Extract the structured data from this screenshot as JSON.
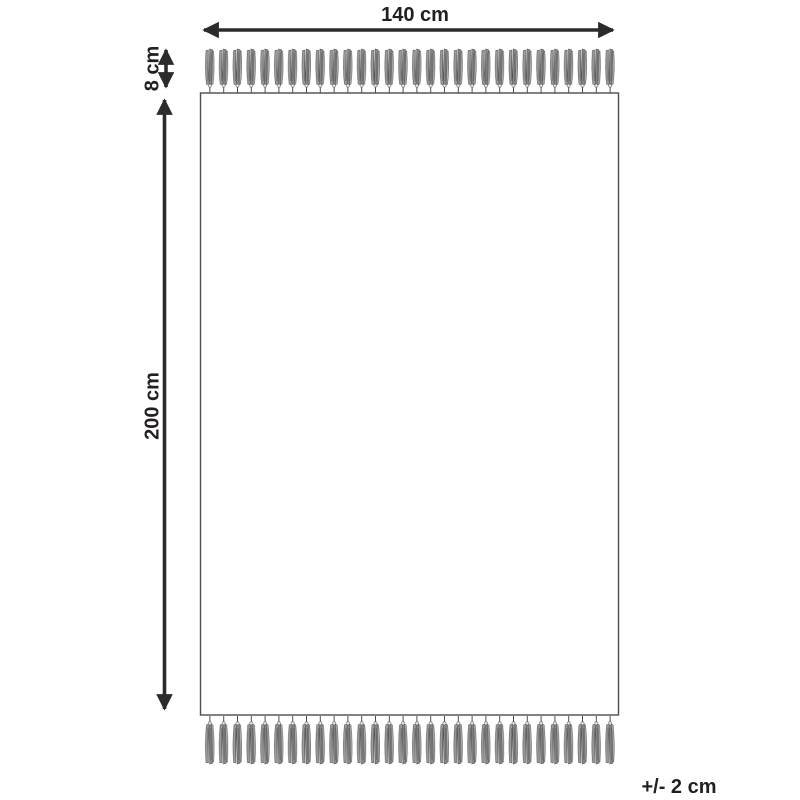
{
  "labels": {
    "width": "140 cm",
    "fringe_height": "8 cm",
    "length": "200 cm",
    "tolerance": "+/- 2 cm"
  },
  "colors": {
    "line": "#2b2b2b",
    "text": "#231f20",
    "outline": "#4d4d4d",
    "tassel_fill": "#969696",
    "background": "#ffffff"
  }
}
